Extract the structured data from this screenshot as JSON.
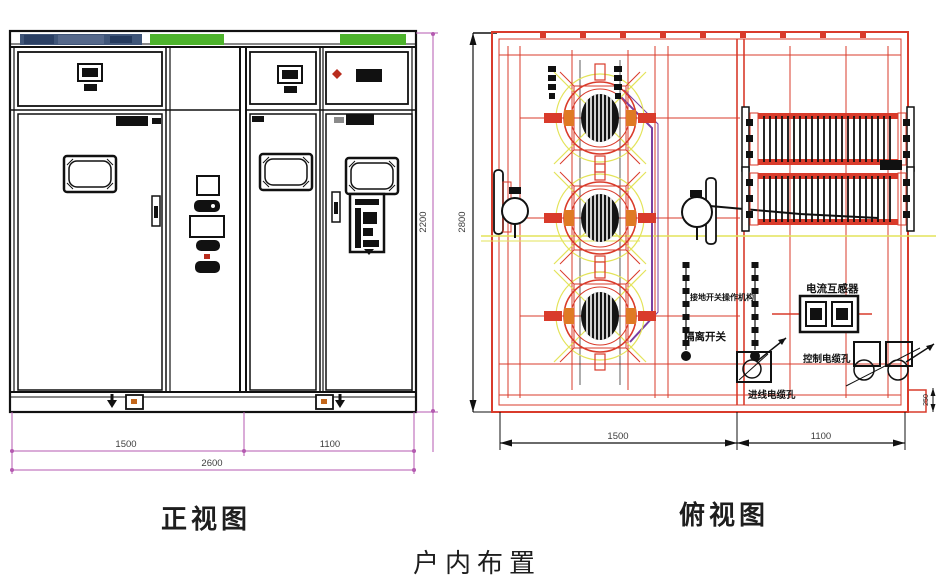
{
  "title": {
    "caption": "户内布置"
  },
  "front_view": {
    "caption": "正视图",
    "dim_height": "2200",
    "dim_left": "1500",
    "dim_right": "1100",
    "dim_total": "2600"
  },
  "top_view": {
    "caption": "俯视图",
    "dim_depth": "2800",
    "dim_left": "1500",
    "dim_right": "1100",
    "dim_step": "250",
    "labels": {
      "current_transformer": "电流互感器",
      "earth_switch_mechanism": "接地开关操作机构",
      "disconnector": "隔离开关",
      "control_cable_hole": "控制电缆孔",
      "incoming_cable_hole": "进线电缆孔"
    }
  },
  "colors": {
    "drawing_black": "#1c1c1c",
    "cad_red": "#d93b2b",
    "dim_magenta": "#b45ab0",
    "accent_green": "#4db32c",
    "accent_yellow": "#e3e35a",
    "routing_purple": "#7a3fa2",
    "nameplate_blue": "#3f5578",
    "accent_orange": "#df7a25"
  }
}
